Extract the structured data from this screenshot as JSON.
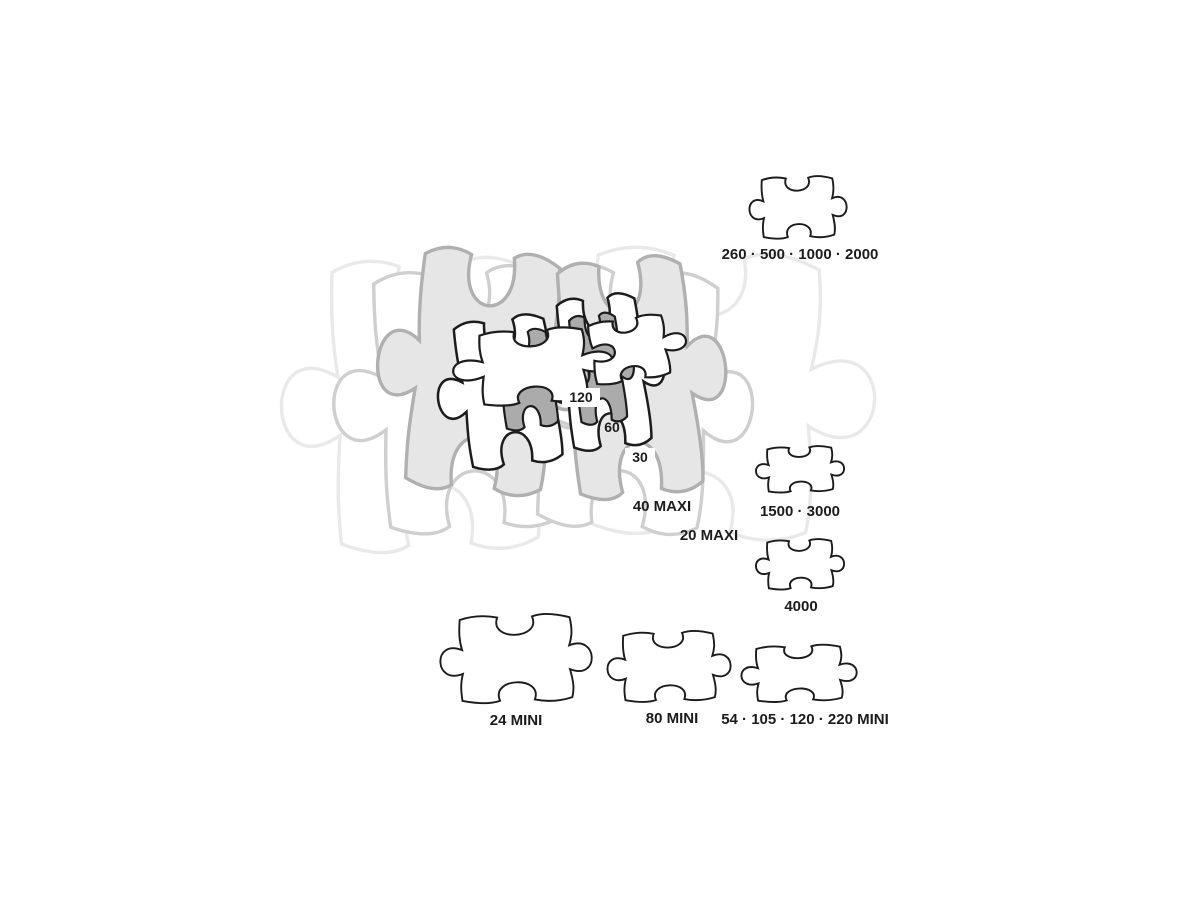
{
  "pieces": {
    "center": [
      {
        "name": "20-maxi",
        "label": "20 MAXI"
      },
      {
        "name": "40-maxi",
        "label": "40 MAXI"
      },
      {
        "name": "30",
        "label": "30"
      },
      {
        "name": "60",
        "label": "60"
      },
      {
        "name": "120",
        "label": "120"
      }
    ],
    "right_column": [
      {
        "name": "260-500-1000-2000",
        "label": "260 · 500 · 1000 · 2000"
      },
      {
        "name": "1500-3000",
        "label": "1500 · 3000"
      },
      {
        "name": "4000",
        "label": "4000"
      }
    ],
    "bottom_row": [
      {
        "name": "24-mini",
        "label": "24 MINI"
      },
      {
        "name": "80-mini",
        "label": "80 MINI"
      },
      {
        "name": "54-105-120-220-mini",
        "label": "54 · 105 · 120 · 220 MINI"
      }
    ]
  },
  "colors": {
    "background": "#ffffff",
    "text": "#1c1c1c",
    "outline_black": "#1c1c1c",
    "fill_white": "#ffffff",
    "fill_dark_gray": "#ababab",
    "fill_light_gray": "#e6e6e6",
    "stroke_mid_gray": "#b0b0b0",
    "stroke_faint_gray": "#cfcfcf",
    "stroke_faintest_gray": "#e9e9e9"
  }
}
